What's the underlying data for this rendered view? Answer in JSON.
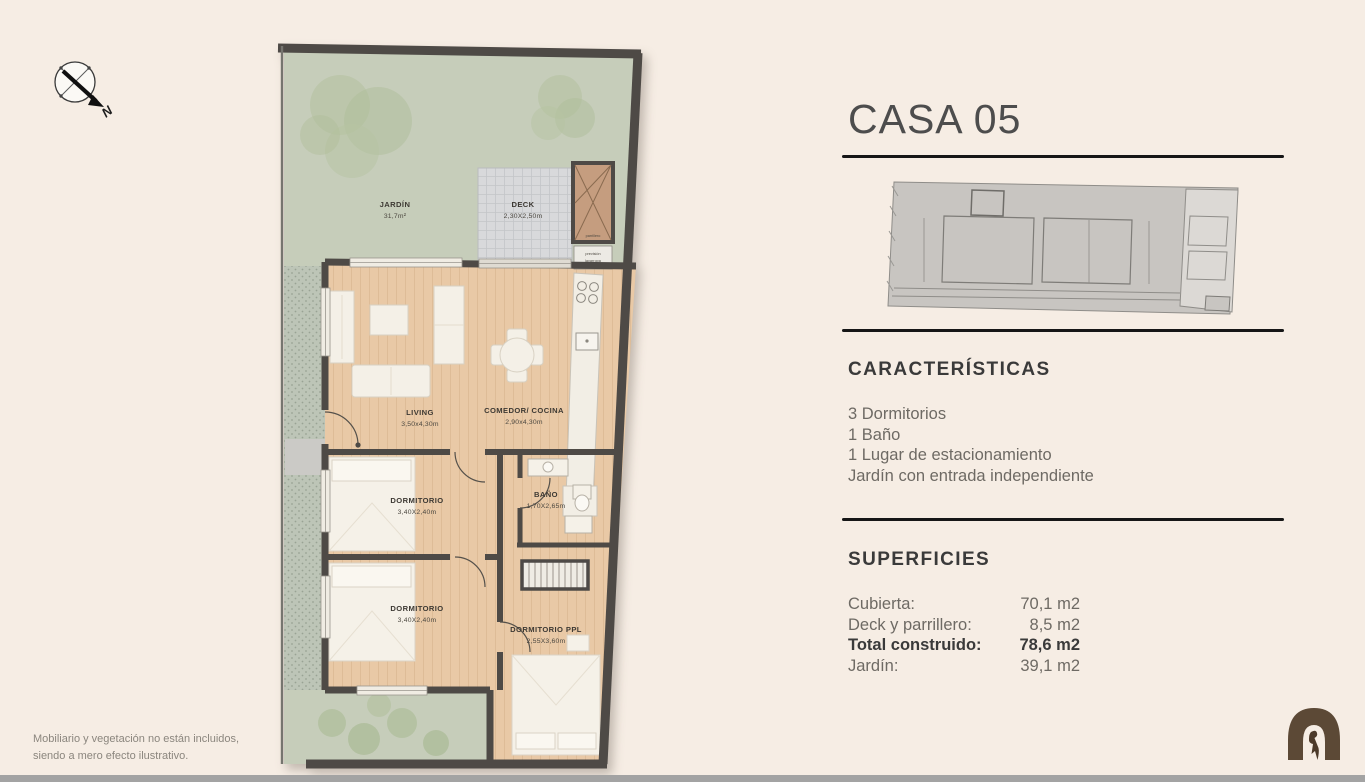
{
  "page": {
    "background": "#f6ede4",
    "disclaimer_line1": "Mobiliario y vegetación no están incluidos,",
    "disclaimer_line2": "siendo a mero efecto ilustrativo."
  },
  "compass": {
    "north": "N"
  },
  "panel": {
    "title": "CASA 05",
    "caracteristicas": {
      "heading": "CARACTERÍSTICAS",
      "items": [
        "3 Dormitorios",
        "1 Baño",
        "1 Lugar de estacionamiento",
        "Jardín con entrada independiente"
      ]
    },
    "superficies": {
      "heading": "SUPERFICIES",
      "rows": [
        {
          "label": "Cubierta:",
          "value": "70,1 m2",
          "bold": false
        },
        {
          "label": "Deck y parrillero:",
          "value": "8,5 m2",
          "bold": false
        },
        {
          "label": "Total construido:",
          "value": "78,6 m2",
          "bold": true
        },
        {
          "label": "Jardín:",
          "value": "39,1 m2",
          "bold": false
        }
      ]
    }
  },
  "plan": {
    "jardin": {
      "name": "JARDÍN",
      "area": "31,7m²"
    },
    "deck": {
      "name": "DECK",
      "dims": "2,30X2,50m"
    },
    "parrillero": {
      "label": "parrillero"
    },
    "laundry": {
      "line1": "previsión",
      "line2": "lavarropa"
    },
    "living": {
      "name": "LIVING",
      "dims": "3,50x4,30m"
    },
    "comedor": {
      "name": "COMEDOR/ COCINA",
      "dims": "2,90x4,30m"
    },
    "dormitorio1": {
      "name": "DORMITORIO",
      "dims": "3,40X2,40m"
    },
    "dormitorio2": {
      "name": "DORMITORIO",
      "dims": "3,40X2,40m"
    },
    "bano": {
      "name": "BAÑO",
      "dims": "1,70X2,65m"
    },
    "dormitorio_ppl": {
      "name": "DORMITORIO PPL",
      "dims": "2,55X3,60m"
    }
  },
  "icons": {
    "compass": "compass-rose-icon",
    "logo": "arch-bird-logo"
  },
  "colors": {
    "wall": "#4e4a46",
    "garden": "#c6cdba",
    "wood": "#e9c9a6",
    "deck": "#d8d9db",
    "rule_dark": "#161616",
    "logo_brown": "#5c4936",
    "text_dark": "#3a3a3a",
    "text_gray": "#6e6a64"
  }
}
